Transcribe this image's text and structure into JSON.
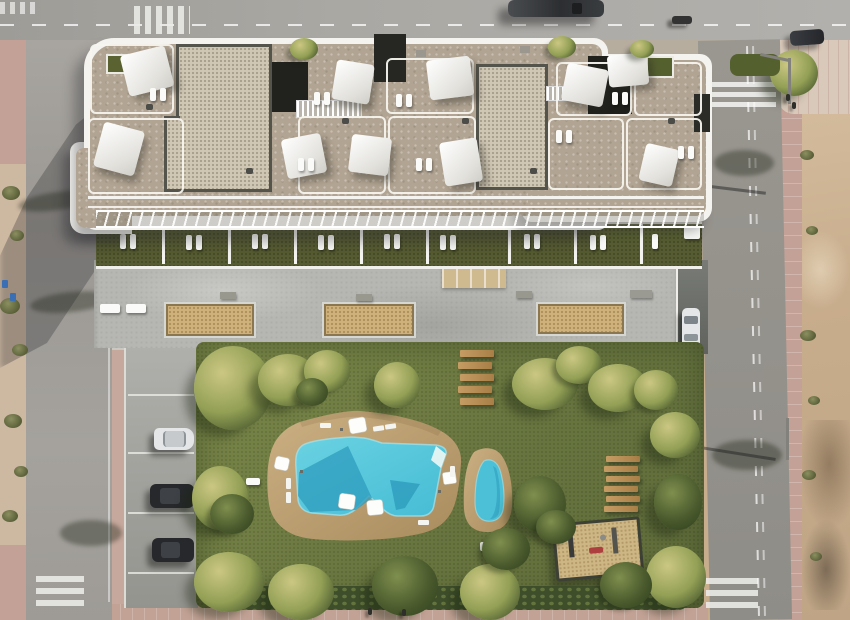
{
  "scene": {
    "setting": "aerial-top-down-render-of-residential-apartment-complex",
    "features": {
      "rooftop_shade_sails": 10,
      "ground_floor_terraces": 9,
      "swimming_pools": 2,
      "parked_cars": 6,
      "van_on_top_road": 1,
      "crosswalks": 4,
      "sand_planters_on_plaza": 3,
      "wooden_garden_steps": 5,
      "wooden_garden_benches": 6,
      "playground": 1
    }
  },
  "colors": {
    "sand": "#c8ad8c",
    "sand_light": "#d6c0a1",
    "sand_dark": "#8f795f",
    "asphalt": "#a3a19c",
    "asphalt_dark": "#8f8d88",
    "sidewalk_pink": "#c4a196",
    "tile_pale": "#d9c9bb",
    "concrete": "#b6b6b2",
    "parking_grey": "#9d9d99",
    "wall_white": "#f4f3ef",
    "roof_tan": "#b2a492",
    "roof_light": "#cfc6b4",
    "roof_dark": "#21211d",
    "grass_terrace": "#565b31",
    "grass_garden": "#6e7c41",
    "hedge_dark": "#3e4e2a",
    "tree_light": "#cbc783",
    "tree_mid": "#93a055",
    "tree_dark": "#41512a",
    "pool_light": "#56c6da",
    "pool_dark": "#2e9cbe",
    "deck_tan": "#bb9e70",
    "wood": "#b08a52",
    "sand_pit": "#cfb27b",
    "car_white": "#e4e6e7",
    "car_dark": "#26282b"
  }
}
